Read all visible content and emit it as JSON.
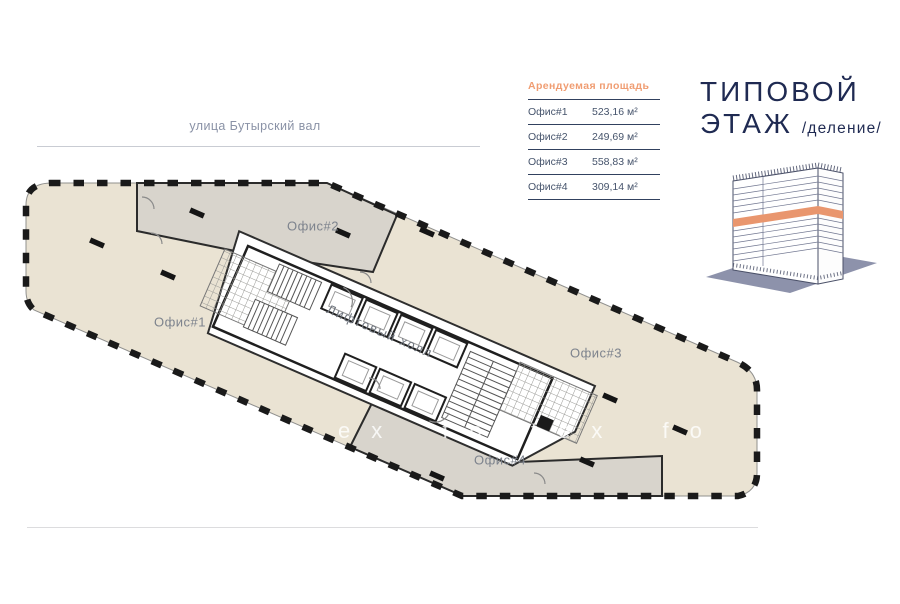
{
  "street": {
    "label": "улица Бутырский вал"
  },
  "area_table": {
    "header": "Арендуемая площадь",
    "rows": [
      {
        "label": "Офис#1",
        "value": "523,16 м²"
      },
      {
        "label": "Офис#2",
        "value": "249,69 м²"
      },
      {
        "label": "Офис#3",
        "value": "558,83 м²"
      },
      {
        "label": "Офис#4",
        "value": "309,14 м²"
      }
    ]
  },
  "title": {
    "line1": "ТИПОВОЙ",
    "line2": "ЭТАЖ",
    "suffix": "/деление/"
  },
  "plan": {
    "offices": [
      {
        "label": "Офис#1"
      },
      {
        "label": "Офис#2"
      },
      {
        "label": "Офис#3"
      },
      {
        "label": "Офис#4"
      }
    ],
    "lift_hall_label": "Лифтовый холл",
    "watermark": "ex fortex fo"
  },
  "colors": {
    "accent_orange": "#f09d72",
    "navy": "#1f2a52",
    "office_beige": "#eae3d3",
    "office_grey": "#d8d4cc",
    "building_base": "#8d92ab",
    "building_band": "#e9966e"
  }
}
